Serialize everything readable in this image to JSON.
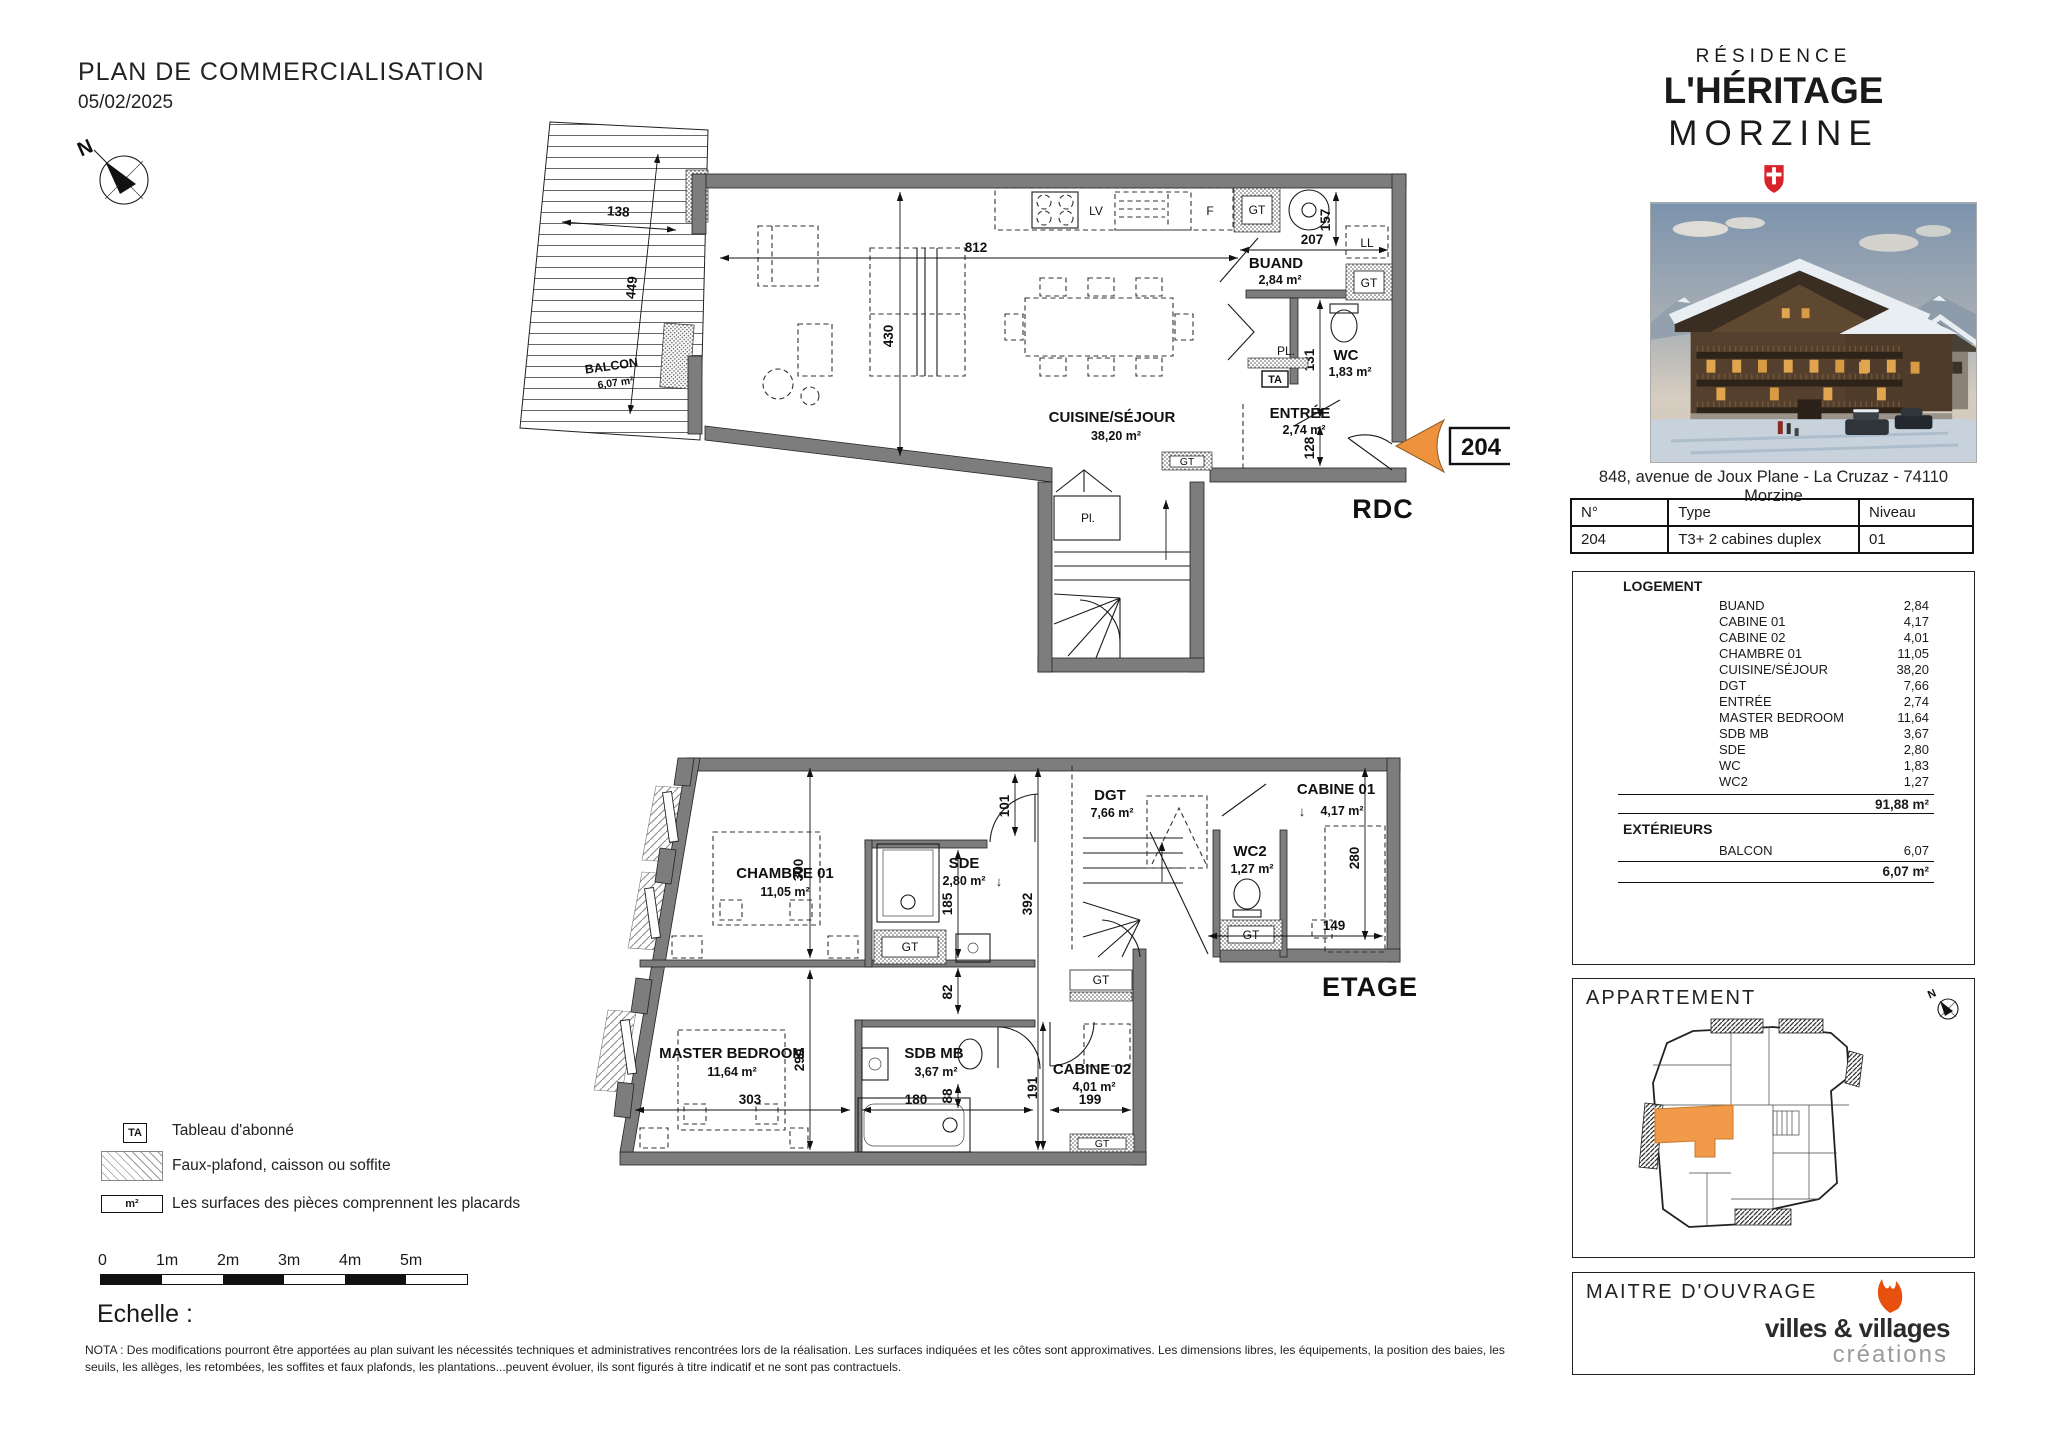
{
  "page": {
    "title": "PLAN DE COMMERCIALISATION",
    "date": "05/02/2025",
    "echelle": "Echelle :",
    "nota": "NOTA : Des modifications pourront être apportées au plan suivant les nécessités techniques et administratives rencontrées lors de la réalisation. Les surfaces indiquées et les côtes sont approximatives. Les dimensions libres, les équipements, la position des baies, les seuils, les allèges, les retombées, les soffites et faux plafonds, les plantations...peuvent évoluer, ils sont figurés à titre indicatif et ne sont pas contractuels."
  },
  "glyphs": {
    "north": "N",
    "down_arrow": "↓"
  },
  "plan_labels": {
    "gt": "GT",
    "ta": "TA",
    "lv": "LV",
    "f": "F",
    "ll": "LL",
    "pl": "PL.",
    "pl_small": "Pl."
  },
  "marker": {
    "unit": "204"
  },
  "rdc": {
    "floor": "RDC",
    "rooms": {
      "balcon": {
        "name": "BALCON",
        "area": "6,07 m²"
      },
      "cuisine": {
        "name": "CUISINE/SÉJOUR",
        "area": "38,20 m²"
      },
      "buand": {
        "name": "BUAND",
        "area": "2,84 m²"
      },
      "wc": {
        "name": "WC",
        "area": "1,83 m²"
      },
      "entree": {
        "name": "ENTRÉE",
        "area": "2,74 m²"
      }
    },
    "dims": {
      "d138": "138",
      "d449": "449",
      "d812": "812",
      "d430": "430",
      "d207": "207",
      "d157": "157",
      "d131": "131",
      "d128": "128"
    }
  },
  "etage": {
    "floor": "ETAGE",
    "rooms": {
      "chambre01": {
        "name": "CHAMBRE 01",
        "area": "11,05 m²"
      },
      "sde": {
        "name": "SDE",
        "area": "2,80 m²"
      },
      "dgt": {
        "name": "DGT",
        "area": "7,66 m²"
      },
      "wc2": {
        "name": "WC2",
        "area": "1,27 m²"
      },
      "cabine01": {
        "name": "CABINE 01",
        "area": "4,17 m²"
      },
      "master": {
        "name": "MASTER BEDROOM",
        "area": "11,64 m²"
      },
      "sdbmb": {
        "name": "SDB MB",
        "area": "3,67 m²"
      },
      "cabine02": {
        "name": "CABINE 02",
        "area": "4,01 m²"
      }
    },
    "dims": {
      "d101": "101",
      "d300": "300",
      "d185": "185",
      "d392": "392",
      "d82": "82",
      "d290": "290",
      "d303": "303",
      "d180": "180",
      "d88": "88",
      "d191": "191",
      "d199": "199",
      "d280": "280",
      "d149": "149"
    }
  },
  "branding": {
    "residence": "RÉSIDENCE",
    "name": "L'HÉRITAGE",
    "city": "MORZINE",
    "address": "848, avenue de Joux Plane - La Cruzaz - 74110 Morzine"
  },
  "unit_table": {
    "headers": {
      "num": "N°",
      "type": "Type",
      "level": "Niveau"
    },
    "row": {
      "num": "204",
      "type": "T3+ 2 cabines duplex",
      "level": "01"
    }
  },
  "logement": {
    "title": "LOGEMENT",
    "rows": [
      {
        "label": "BUAND",
        "value": "2,84"
      },
      {
        "label": "CABINE 01",
        "value": "4,17"
      },
      {
        "label": "CABINE 02",
        "value": "4,01"
      },
      {
        "label": "CHAMBRE 01",
        "value": "11,05"
      },
      {
        "label": "CUISINE/SÉJOUR",
        "value": "38,20"
      },
      {
        "label": "DGT",
        "value": "7,66"
      },
      {
        "label": "ENTRÉE",
        "value": "2,74"
      },
      {
        "label": "MASTER BEDROOM",
        "value": "11,64"
      },
      {
        "label": "SDB MB",
        "value": "3,67"
      },
      {
        "label": "SDE",
        "value": "2,80"
      },
      {
        "label": "WC",
        "value": "1,83"
      },
      {
        "label": "WC2",
        "value": "1,27"
      }
    ],
    "total": "91,88 m²",
    "ext_title": "EXTÉRIEURS",
    "ext_rows": [
      {
        "label": "BALCON",
        "value": "6,07"
      }
    ],
    "ext_total": "6,07 m²"
  },
  "apartment": {
    "title": "APPARTEMENT"
  },
  "owner": {
    "title": "MAITRE D'OUVRAGE",
    "logo_main": "villes & villages",
    "logo_sub": "créations"
  },
  "scalebar": {
    "ticks": [
      "0",
      "1m",
      "2m",
      "3m",
      "4m",
      "5m"
    ]
  },
  "legend": {
    "ta_symbol": "TA",
    "ta_label": "Tableau d'abonné",
    "hatch_label": "Faux-plafond, caisson ou soffite",
    "m2_symbol": "m²",
    "m2_label": "Les surfaces des pièces comprennent les placards"
  },
  "colors": {
    "accent_orange": "#EF923E",
    "shield_red": "#D8232A",
    "logo_orange": "#E8500F",
    "logo_gray": "#9B9B9B",
    "wall_gray": "#7D7D7D"
  }
}
